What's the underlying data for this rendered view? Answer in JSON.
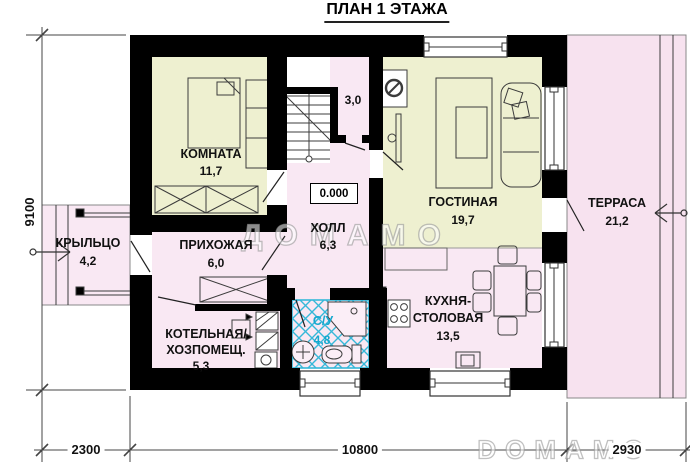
{
  "title": "ПЛАН 1 ЭТАЖА",
  "watermarks": {
    "center": "ДОМАМО",
    "corner": "DOMAMO"
  },
  "elevation_mark": "0.000",
  "rooms": {
    "bedroom": {
      "label": "КОМНАТА",
      "area": "11,7"
    },
    "living_room": {
      "label": "ГОСТИНАЯ",
      "area": "19,7"
    },
    "terrace": {
      "label": "ТЕРРАСА",
      "area": "21,2"
    },
    "porch": {
      "label": "КРЫЛЬЦО",
      "area": "4,2"
    },
    "entry_hall": {
      "label": "ПРИХОЖАЯ",
      "area": "6,0"
    },
    "hall": {
      "label": "ХОЛЛ",
      "area": "6,3"
    },
    "boiler_room": {
      "label_line1": "КОТЕЛЬНАЯ/",
      "label_line2": "ХОЗПОМЕЩ.",
      "area": "5,3"
    },
    "bathroom": {
      "label": "С/У",
      "area": "4,8"
    },
    "kitchen_dining": {
      "label_line1": "КУХНЯ-",
      "label_line2": "СТОЛОВАЯ",
      "area": "13,5"
    },
    "stair_closet": {
      "area": "3,0"
    }
  },
  "dimensions": {
    "left_total": "9100",
    "bottom": {
      "porch": "2300",
      "house": "10800",
      "terrace": "2930"
    }
  },
  "colors": {
    "walls": "#000000",
    "room_warm": "#eef0d0",
    "room_pink": "#f9e8f3",
    "terrace_pink": "#f7e2ef",
    "tile_cyan": "#35b8d9",
    "bath_label_cyan": "#14a8ce"
  }
}
